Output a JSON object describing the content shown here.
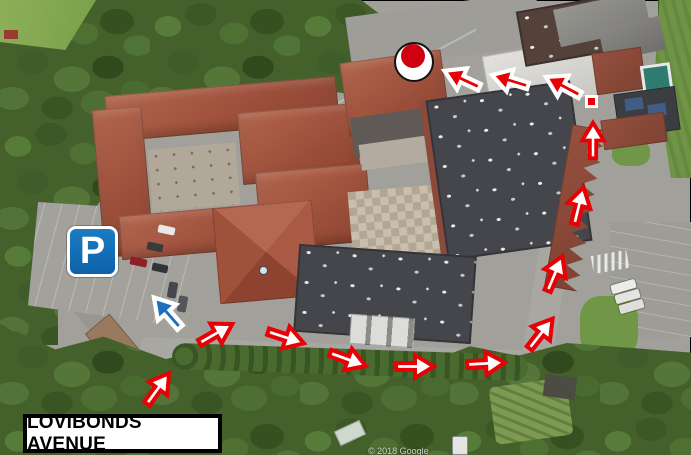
{
  "map": {
    "description": "Annotated aerial route map showing walking route from Lovibonds Avenue around the buildings to the entrance",
    "street_label": "LOVIBONDS AVENUE",
    "watermark": "© 2018 Google",
    "parking_badge": {
      "letter": "P",
      "x": 67,
      "y": 226,
      "size": 51
    },
    "colors": {
      "route_red": "#e80005",
      "arrow_white": "#ffffff",
      "blue_arrow": "#1b6fbd",
      "parking_blue": "#1273b9",
      "destination_dot_red": "#cf000f",
      "label_border": "#000000",
      "label_background": "#ffffff"
    },
    "destination_marker": {
      "cx": 414,
      "cy": 62,
      "outer_r": 20,
      "dot_r": 12
    },
    "route_start_square": {
      "x": 585,
      "y": 95,
      "size": 13
    },
    "blue_arrow": {
      "cx": 167,
      "cy": 312,
      "rot": 229,
      "len": 52
    },
    "white_arrows": [
      {
        "cx": 158,
        "cy": 388,
        "rot": -54,
        "len": 48
      },
      {
        "cx": 216,
        "cy": 333,
        "rot": -30,
        "len": 48
      },
      {
        "cx": 286,
        "cy": 337,
        "rot": 18,
        "len": 48
      },
      {
        "cx": 348,
        "cy": 359,
        "rot": 20,
        "len": 48
      },
      {
        "cx": 415,
        "cy": 366,
        "rot": 0,
        "len": 48
      },
      {
        "cx": 486,
        "cy": 363,
        "rot": -3,
        "len": 48
      },
      {
        "cx": 541,
        "cy": 333,
        "rot": -52,
        "len": 48
      },
      {
        "cx": 555,
        "cy": 273,
        "rot": -67,
        "len": 48
      },
      {
        "cx": 579,
        "cy": 205,
        "rot": -76,
        "len": 48
      },
      {
        "cx": 593,
        "cy": 140,
        "rot": -90,
        "len": 46
      }
    ],
    "red_arrows": [
      {
        "cx": 462,
        "cy": 79,
        "rot": 205,
        "len": 50
      },
      {
        "cx": 510,
        "cy": 80,
        "rot": 197,
        "len": 48
      },
      {
        "cx": 563,
        "cy": 86,
        "rot": 208,
        "len": 50
      }
    ]
  }
}
